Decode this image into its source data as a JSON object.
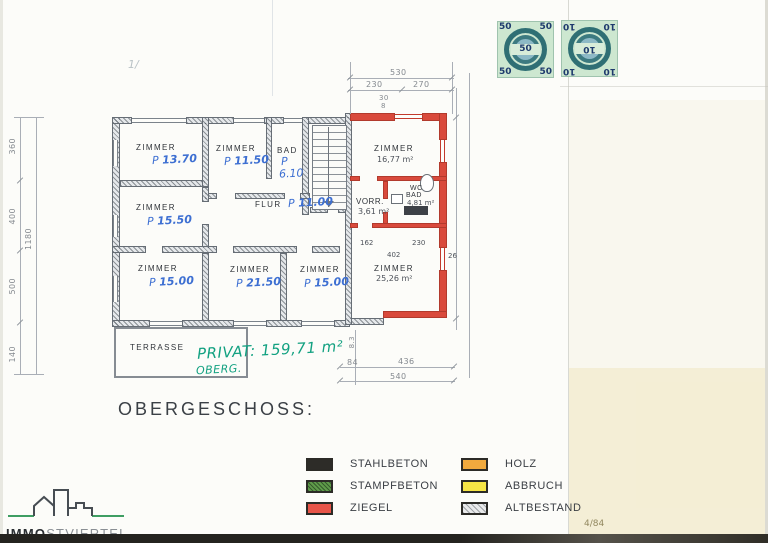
{
  "document": {
    "heading": "OBERGESCHOSS:",
    "page_number": "4/84",
    "fold_mark": "1/"
  },
  "stamps": [
    {
      "value": "50"
    },
    {
      "value": "10"
    }
  ],
  "logo": {
    "text_bold": "IMMO",
    "text_light": "STVIERTEL"
  },
  "handwriting": {
    "privat": "PRIVAT: 159,71 m²",
    "floor": "OBERG."
  },
  "plan": {
    "rooms": [
      {
        "id": "zimmer-1370",
        "label": "ZIMMER",
        "prefix": "P",
        "area": "13.70"
      },
      {
        "id": "zimmer-1150",
        "label": "ZIMMER",
        "prefix": "P",
        "area": "11.50"
      },
      {
        "id": "bad",
        "label": "BAD",
        "prefix": "P",
        "area": "6.10"
      },
      {
        "id": "zimmer-1677",
        "label": "ZIMMER",
        "area": "16,77 m²"
      },
      {
        "id": "zimmer-1550",
        "label": "ZIMMER",
        "prefix": "P",
        "area": "15.50"
      },
      {
        "id": "flur",
        "label": "FLUR",
        "prefix": "P",
        "area": "11.00"
      },
      {
        "id": "vorr",
        "label": "VORR.",
        "area": "3,61 m²"
      },
      {
        "id": "wc-bad",
        "label": "WC",
        "label2": "BAD",
        "area": "4,81 m²"
      },
      {
        "id": "zimmer-1500a",
        "label": "ZIMMER",
        "prefix": "P",
        "area": "15.00"
      },
      {
        "id": "zimmer-2150",
        "label": "ZIMMER",
        "prefix": "P",
        "area": "21.50"
      },
      {
        "id": "zimmer-1500b",
        "label": "ZIMMER",
        "prefix": "P",
        "area": "15.00"
      },
      {
        "id": "zimmer-2526",
        "label": "ZIMMER",
        "area": "25,26 m²"
      },
      {
        "id": "terrasse",
        "label": "TERRASSE"
      }
    ],
    "dimensions": {
      "top_total": "530",
      "top_left": "230",
      "top_right": "270",
      "top_small_a": "30",
      "top_small_b": "8",
      "bottom_a": "84",
      "bottom_b": "436",
      "bottom_total": "540",
      "bottom_small": "8.3",
      "left_outer": [
        "360",
        "400",
        "500",
        "140"
      ],
      "left_inner": "1180",
      "interior": [
        "162",
        "230",
        "402",
        "26"
      ]
    },
    "wall_colors": {
      "ziegel_new": "#d94a3c",
      "altbestand_old": "#c7ccd1"
    }
  },
  "legend": {
    "items": [
      {
        "label": "STAHLBETON",
        "color": "#2d2c28",
        "pattern": "solid"
      },
      {
        "label": "STAMPFBETON",
        "color": "#5f9c4a",
        "pattern": "speckled"
      },
      {
        "label": "ZIEGEL",
        "color": "#e85549",
        "pattern": "solid"
      },
      {
        "label": "HOLZ",
        "color": "#f0a93e",
        "pattern": "solid"
      },
      {
        "label": "ABBRUCH",
        "color": "#f6e545",
        "pattern": "solid"
      },
      {
        "label": "ALTBESTAND",
        "color": "#e9eaeb",
        "pattern": "hatched"
      }
    ]
  }
}
